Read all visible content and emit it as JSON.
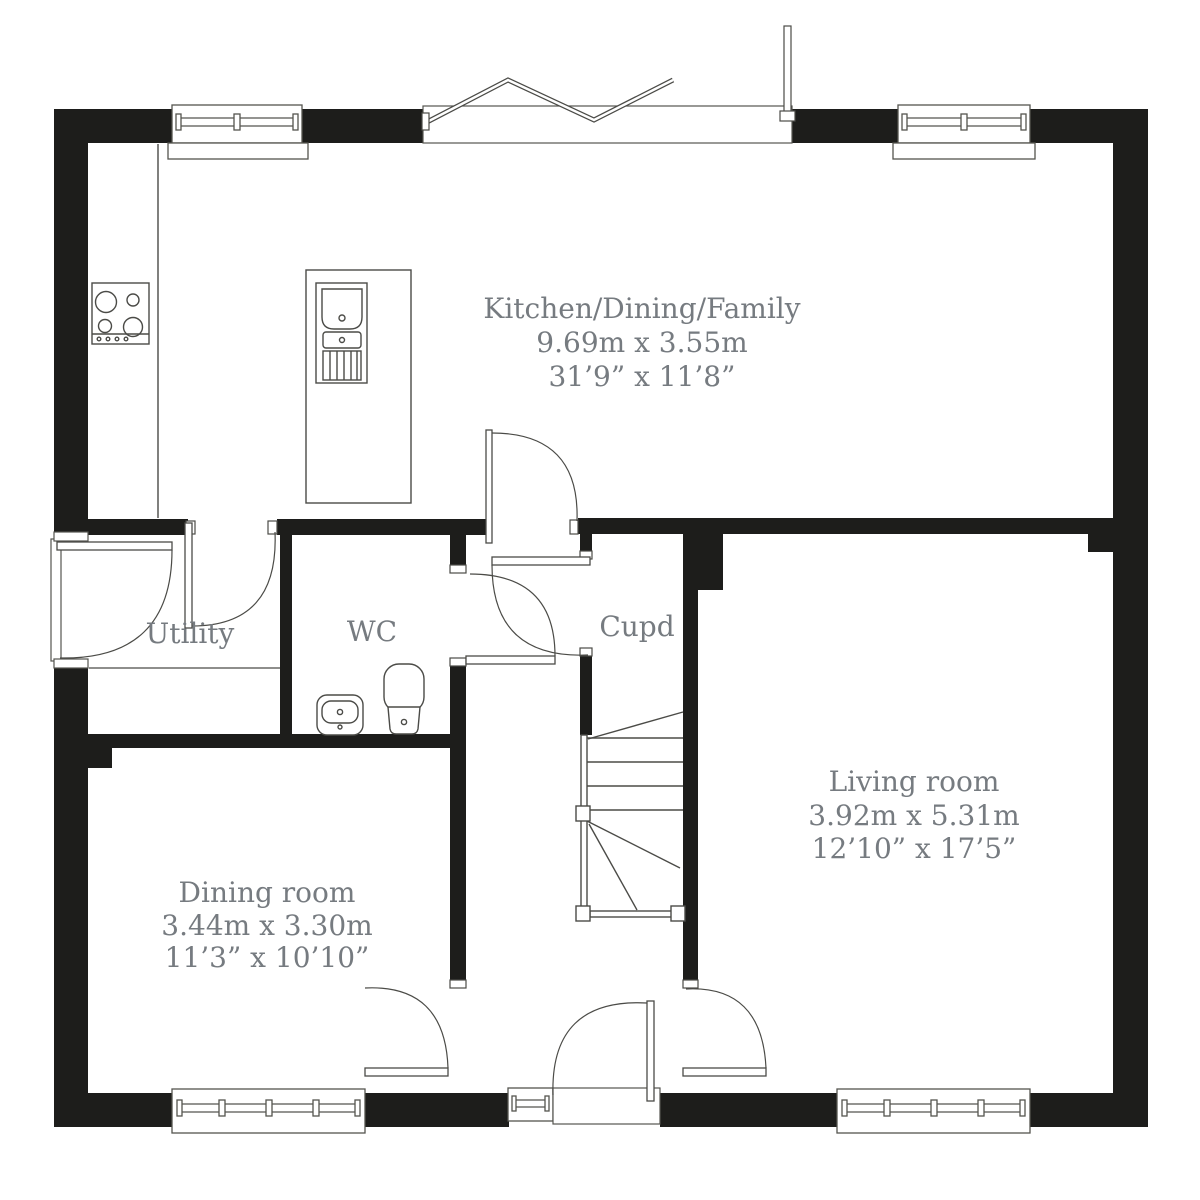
{
  "plan": {
    "type": "ground-floor-plan",
    "rooms": {
      "kitchen": {
        "name": "Kitchen/Dining/Family",
        "metric": "9.69m x 3.55m",
        "imperial": "31’9” x 11’8”"
      },
      "utility": {
        "name": "Utility"
      },
      "wc": {
        "name": "WC"
      },
      "cupd": {
        "name": "Cupd"
      },
      "living": {
        "name": "Living room",
        "metric": "3.92m x 5.31m",
        "imperial": "12’10” x 17’5”"
      },
      "dining": {
        "name": "Dining room",
        "metric": "3.44m x 3.30m",
        "imperial": "11’3” x 10’10”"
      }
    },
    "colors": {
      "wall": "#1d1d1b",
      "line": "#4b4b47",
      "label": "#767b80",
      "background": "#ffffff"
    }
  }
}
